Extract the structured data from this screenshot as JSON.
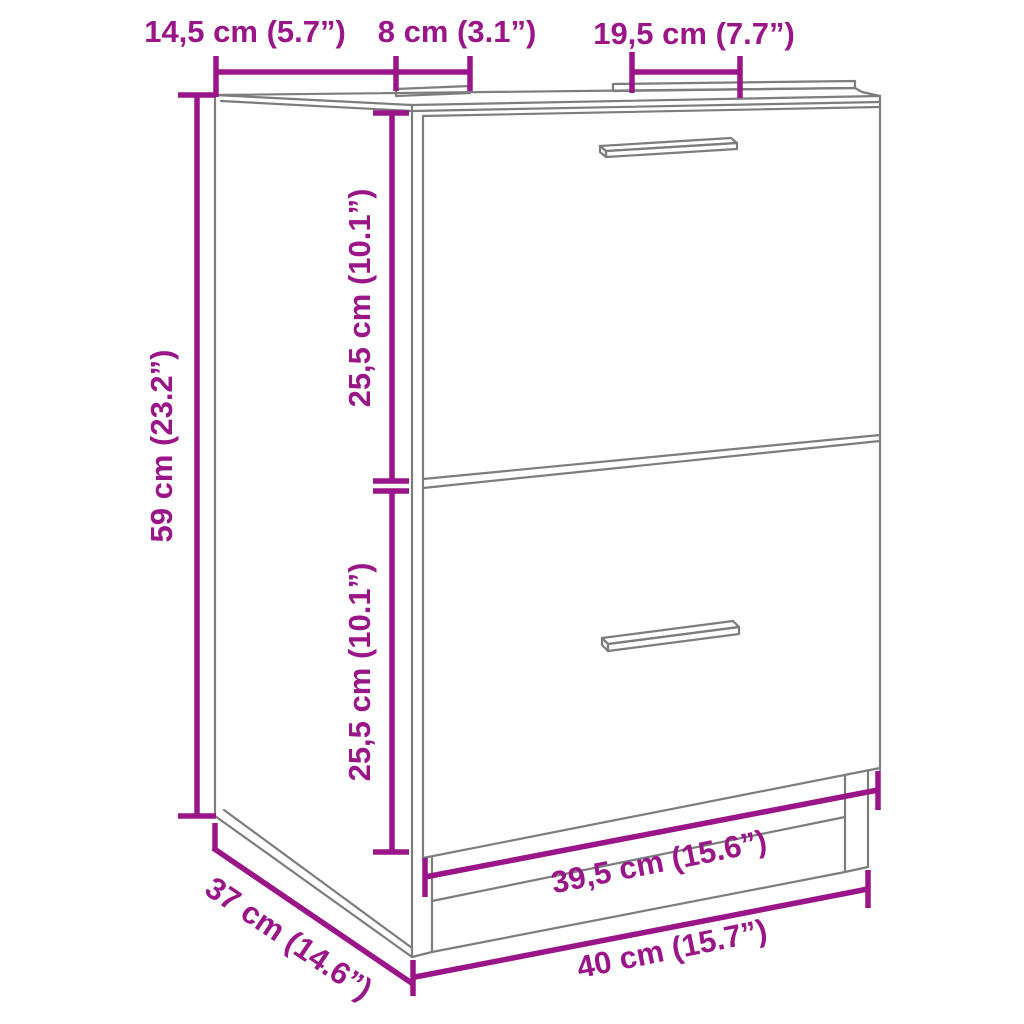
{
  "diagram": {
    "product": "sink-cabinet-with-two-drawers",
    "colors": {
      "dimension": "#9A1588",
      "outline": "#7D7D7D",
      "background": "#FFFFFF"
    },
    "dimensions": {
      "top_left_width": "14,5 cm (5.7”)",
      "top_middle_width": "8 cm (3.1”)",
      "top_right_width": "19,5 cm (7.7”)",
      "overall_height": "59 cm (23.2”)",
      "upper_drawer_height": "25,5 cm (10.1”)",
      "lower_drawer_height": "25,5 cm (10.1”)",
      "inner_width": "39,5 cm (15.6”)",
      "overall_width": "40 cm (15.7”)",
      "depth": "37 cm (14.6”)"
    }
  }
}
